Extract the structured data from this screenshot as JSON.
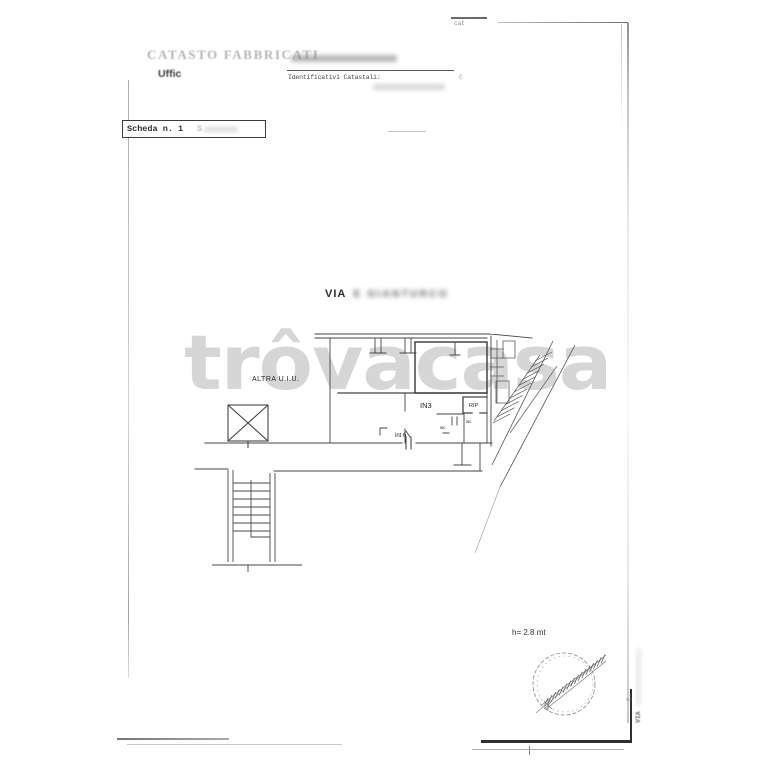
{
  "corner": {
    "note": "cat"
  },
  "header": {
    "registry": "CATASTO FABBRICATI",
    "office": "Uffic",
    "identifiers_label": "Identificativi Catastali:",
    "identifiers_value": "C"
  },
  "scheda": {
    "label": "Scheda n. 1",
    "secondary_prefix": "S"
  },
  "street": {
    "prefix": "VIA",
    "redacted_name": "E GIANTURCO"
  },
  "watermark": {
    "text": "trôvacasa"
  },
  "plan": {
    "labels": {
      "other_unit": "ALTRA U.I.U.",
      "room_in3": "IN3",
      "room_rip": "RIP",
      "unit_int6": "int 6",
      "wc_left": "wc",
      "wc_right": "wc"
    },
    "height_note": "h= 2.8 mt"
  },
  "side_note": {
    "line1": "C.",
    "line2": "VIA"
  },
  "colors": {
    "ink": "#3f3f3f",
    "faded_ink": "#b5b5b5",
    "watermark": "#d0d0d0"
  }
}
